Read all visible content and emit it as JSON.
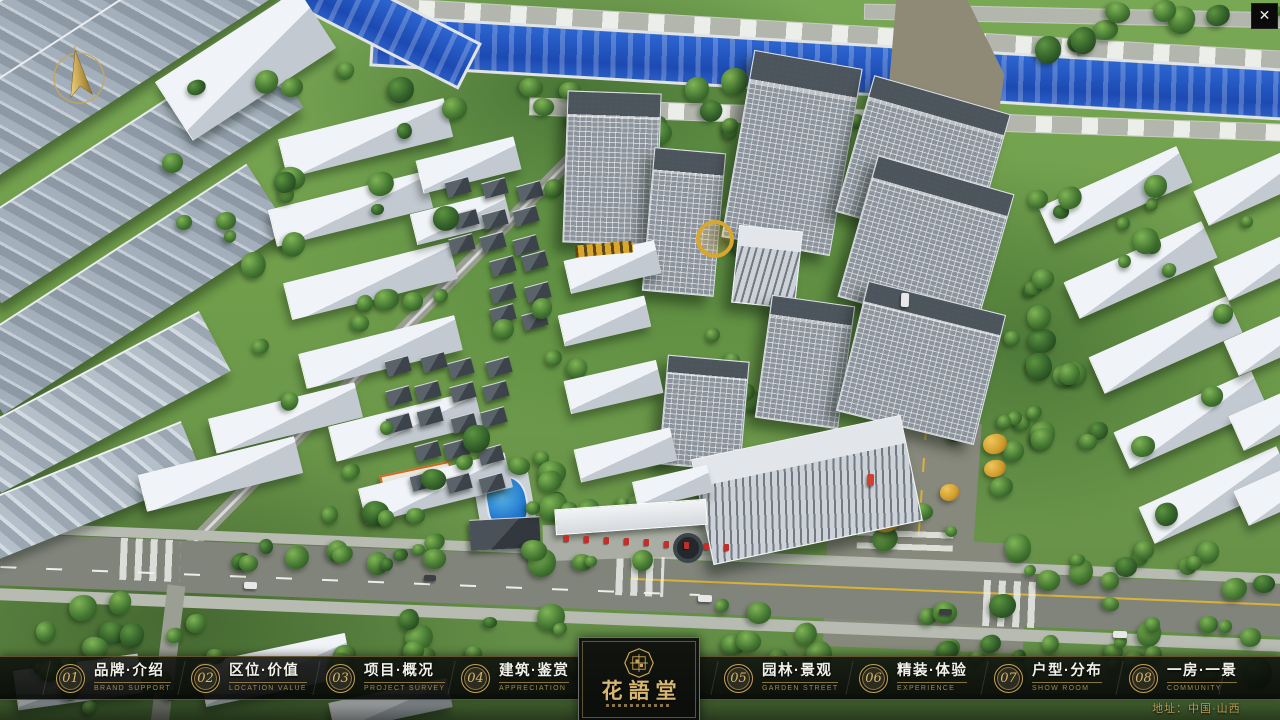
{
  "app": {
    "close_label": "✕"
  },
  "nav": {
    "items": [
      {
        "slug": "brand-intro",
        "number": "01",
        "label_zh": "品牌·介绍",
        "label_en": "BRAND SUPPORT"
      },
      {
        "slug": "location-value",
        "number": "02",
        "label_zh": "区位·价值",
        "label_en": "LOCATION VALUE"
      },
      {
        "slug": "project-survey",
        "number": "03",
        "label_zh": "项目·概况",
        "label_en": "PROJECT SURVEY"
      },
      {
        "slug": "architecture",
        "number": "04",
        "label_zh": "建筑·鉴赏",
        "label_en": "APPRECIATION"
      },
      {
        "slug": "garden-landscape",
        "number": "05",
        "label_zh": "园林·景观",
        "label_en": "GARDEN STREET"
      },
      {
        "slug": "interior-experience",
        "number": "06",
        "label_zh": "精装·体验",
        "label_en": "EXPERIENCE"
      },
      {
        "slug": "floorplan",
        "number": "07",
        "label_zh": "户型·分布",
        "label_en": "SHOW ROOM"
      },
      {
        "slug": "room-view",
        "number": "08",
        "label_zh": "一房·一景",
        "label_en": "COMMUNITY"
      }
    ]
  },
  "logo": {
    "name": "花語堂"
  },
  "footer": {
    "address": "地址：中国·山西"
  },
  "colors": {
    "gold": "#c8a759",
    "bar_bg": "#0a0c09",
    "river": "#1c4ab2",
    "grass": "#6f9d4a"
  }
}
